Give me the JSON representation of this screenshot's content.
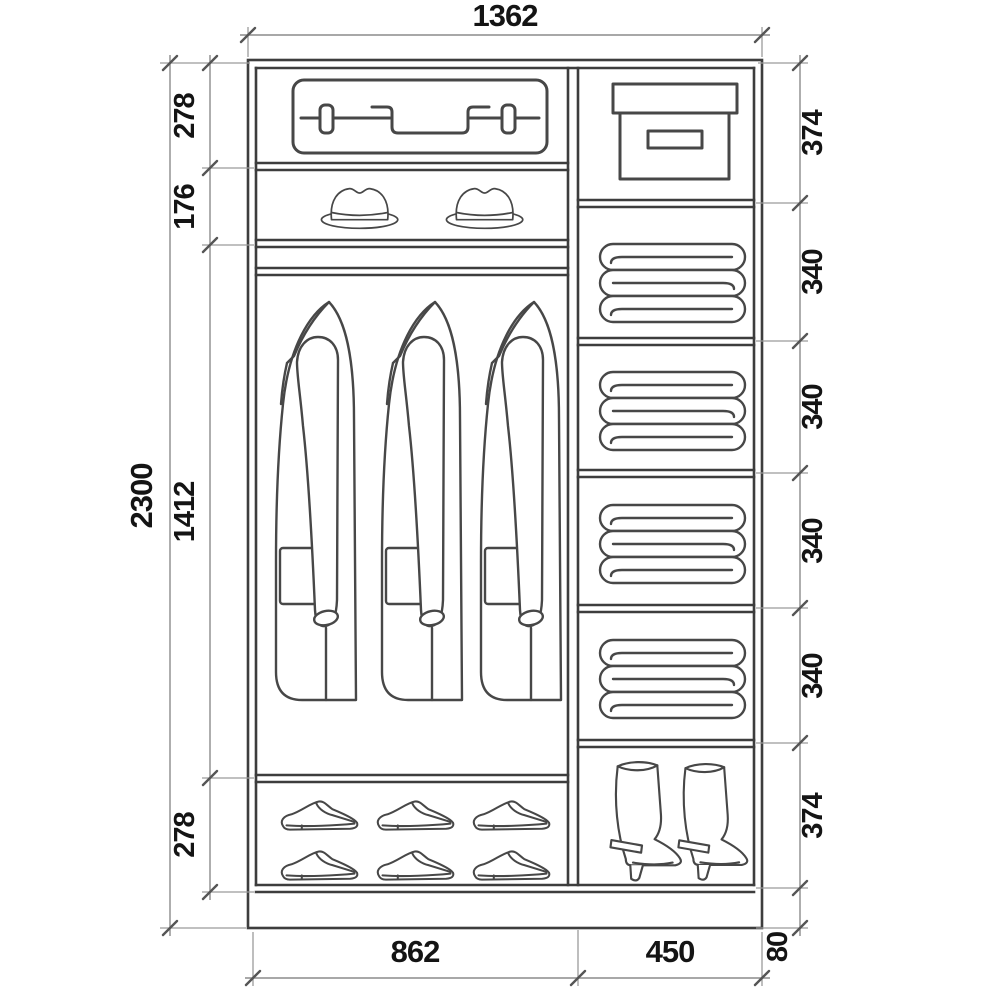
{
  "drawing": {
    "type": "wardrobe-interior-elevation",
    "background": "#ffffff",
    "line_color": "#3d3d3d",
    "dimension_text_color": "#141414"
  },
  "dims": {
    "width": "1362",
    "height": "2300",
    "left": [
      "278",
      "176",
      "1412",
      "278"
    ],
    "right": [
      "374",
      "340",
      "340",
      "340",
      "340",
      "374"
    ],
    "base": "80",
    "bottom": [
      "862",
      "450"
    ]
  },
  "icons": {
    "left_column": [
      "suitcase-icon",
      "hat-icon",
      "coat-icon",
      "shoe-icon"
    ],
    "right_column": [
      "storage-box-icon",
      "folded-linen-icon",
      "boot-icon"
    ],
    "counts": {
      "hats": 2,
      "coats": 3,
      "shoes": 6,
      "linen_shelves": 4,
      "boots": 2
    }
  }
}
